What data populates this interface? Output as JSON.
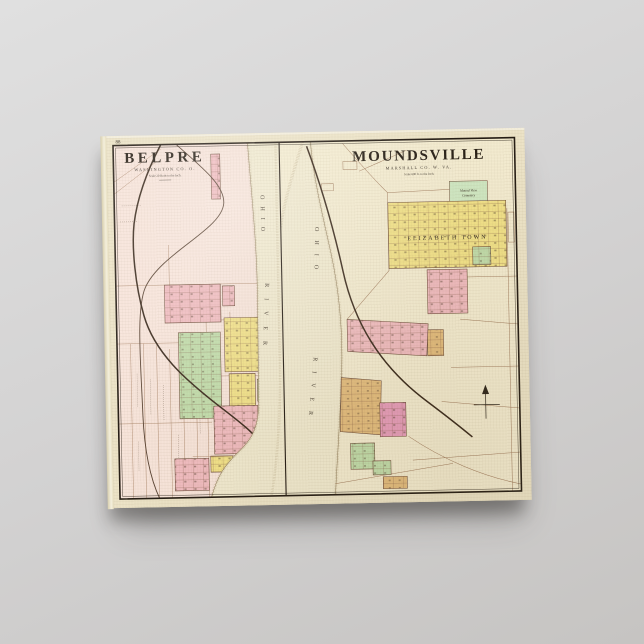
{
  "palette": {
    "bg_top": "#e0e0e0",
    "bg_bottom": "#c6c4c2",
    "canvas_face": "#ece3c7",
    "belpre_bg": "#f7e4da",
    "mounds_bg": "#f3ebd0",
    "river": "#f0e9cf",
    "ink": "#261e15",
    "road": "#9b7a5e",
    "rail": "#3a2a1d",
    "bank": "#b3a17e",
    "block_pink": "#f0bcc0",
    "block_yellow": "#f1e189",
    "block_green": "#c1dcab",
    "block_tan": "#e3bd7f",
    "block_magenta": "#e79ebc",
    "cemetery_green": "#cfe7c2"
  },
  "sheet": {
    "page_number": "88"
  },
  "belpre": {
    "title": "BELPRE",
    "subtitle": "WASHINGTON CO. O.",
    "scale_note": "Scale 20 Rods to the Inch.",
    "river_label_1": "OHIO",
    "river_label_2": "RIVER"
  },
  "moundsville": {
    "title": "MOUNDSVILLE",
    "subtitle": "MARSHALL CO. W. VA.",
    "scale_note": "Scale 600 ft. to the Inch.",
    "river_label_1": "OHIO",
    "river_label_2": "RIVER",
    "elizabethtown_label": "ELIZABETH TOWN",
    "cemetery_label_1": "Mound View",
    "cemetery_label_2": "Cemetery"
  }
}
